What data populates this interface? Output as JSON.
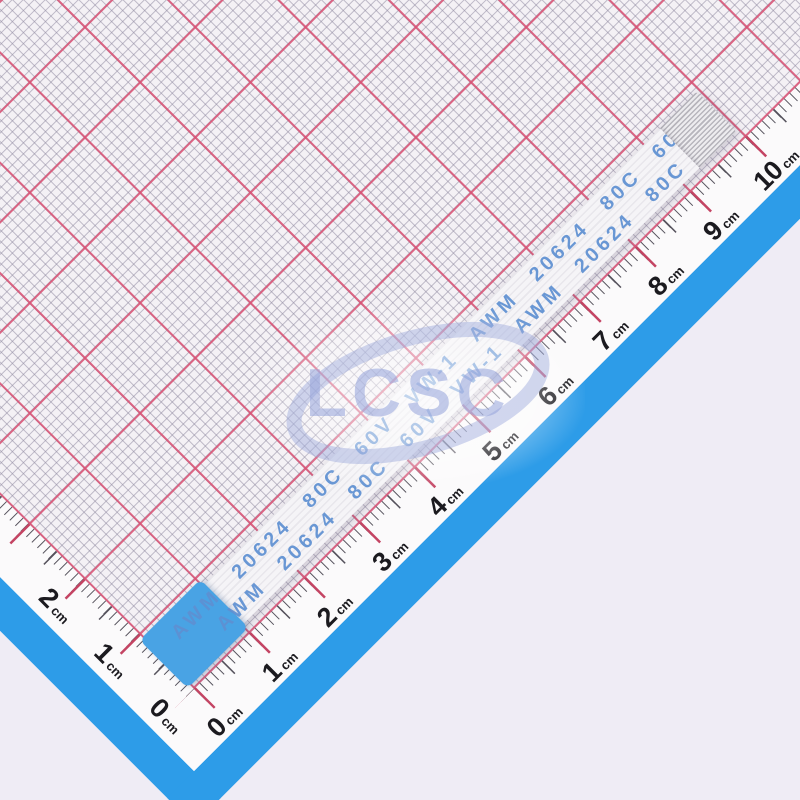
{
  "background_color": "#EFECF5",
  "graph_paper": {
    "paper_color": "#F4F1F5",
    "major_line_color": "#D85274E0",
    "minor_line_color": "#8F89A08C",
    "margin_color": "#FBFAFB",
    "edge_strip_color": "#2D9CE8"
  },
  "rulers": {
    "unit": "cm",
    "bottom": {
      "labels": [
        "0",
        "1",
        "2",
        "3",
        "4",
        "5",
        "6",
        "7",
        "8",
        "9",
        "10"
      ]
    },
    "left": {
      "labels": [
        "0",
        "1",
        "2"
      ]
    },
    "tick_color": "#55525C",
    "cm_tick_color": "#C44463",
    "label_color": "#1B1A1F"
  },
  "cable": {
    "marking_text": "AWM 20624 80C 60V VW-1",
    "marking_repeats": 3,
    "marking_color": "#5E90D2",
    "body_color": "#F5F4F7",
    "stiffener_color": "#49A3E4",
    "contact_stripe_color": "#B7B5BC"
  },
  "watermark": {
    "text": "LCSC",
    "color": "#94A3DA"
  }
}
